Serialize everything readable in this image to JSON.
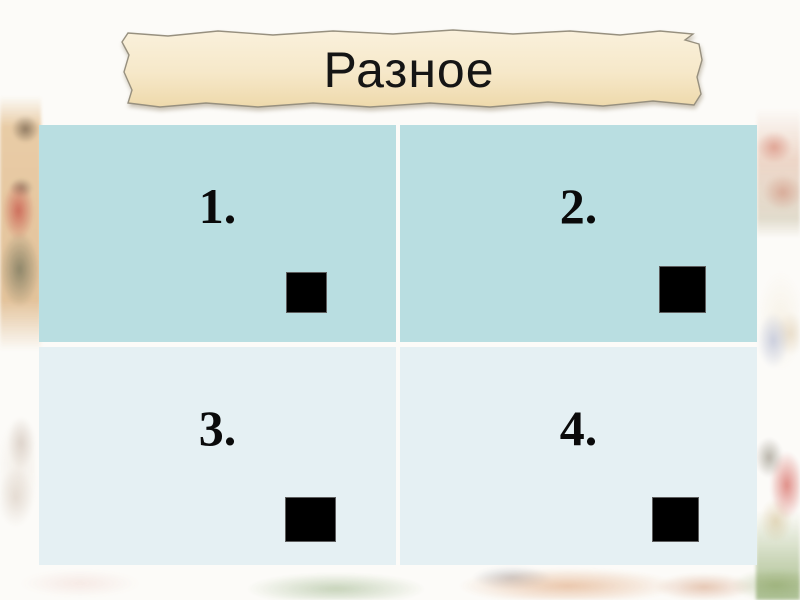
{
  "slide": {
    "title_banner": {
      "label": "Разное"
    },
    "grid": {
      "cells": [
        {
          "number": "1."
        },
        {
          "number": "2."
        },
        {
          "number": "3."
        },
        {
          "number": "4."
        }
      ]
    },
    "colors": {
      "top_row_cell_bg": "#b9dee1",
      "bottom_row_cell_bg": "#e5f0f3",
      "banner_parchment": "#f6e8cb",
      "square": "#000000",
      "slide_bg": "#fcfbf8"
    },
    "decorations": {
      "left": "faded-medieval-scribe-painting",
      "left_lower": "faded-church-painting",
      "right_top": "faded-battle-painting",
      "right_middle": "faded-trinity-icon-painting",
      "right_bottom": "faded-warrior-painting",
      "bottom": "faded-kremlin-castle-painting"
    }
  }
}
